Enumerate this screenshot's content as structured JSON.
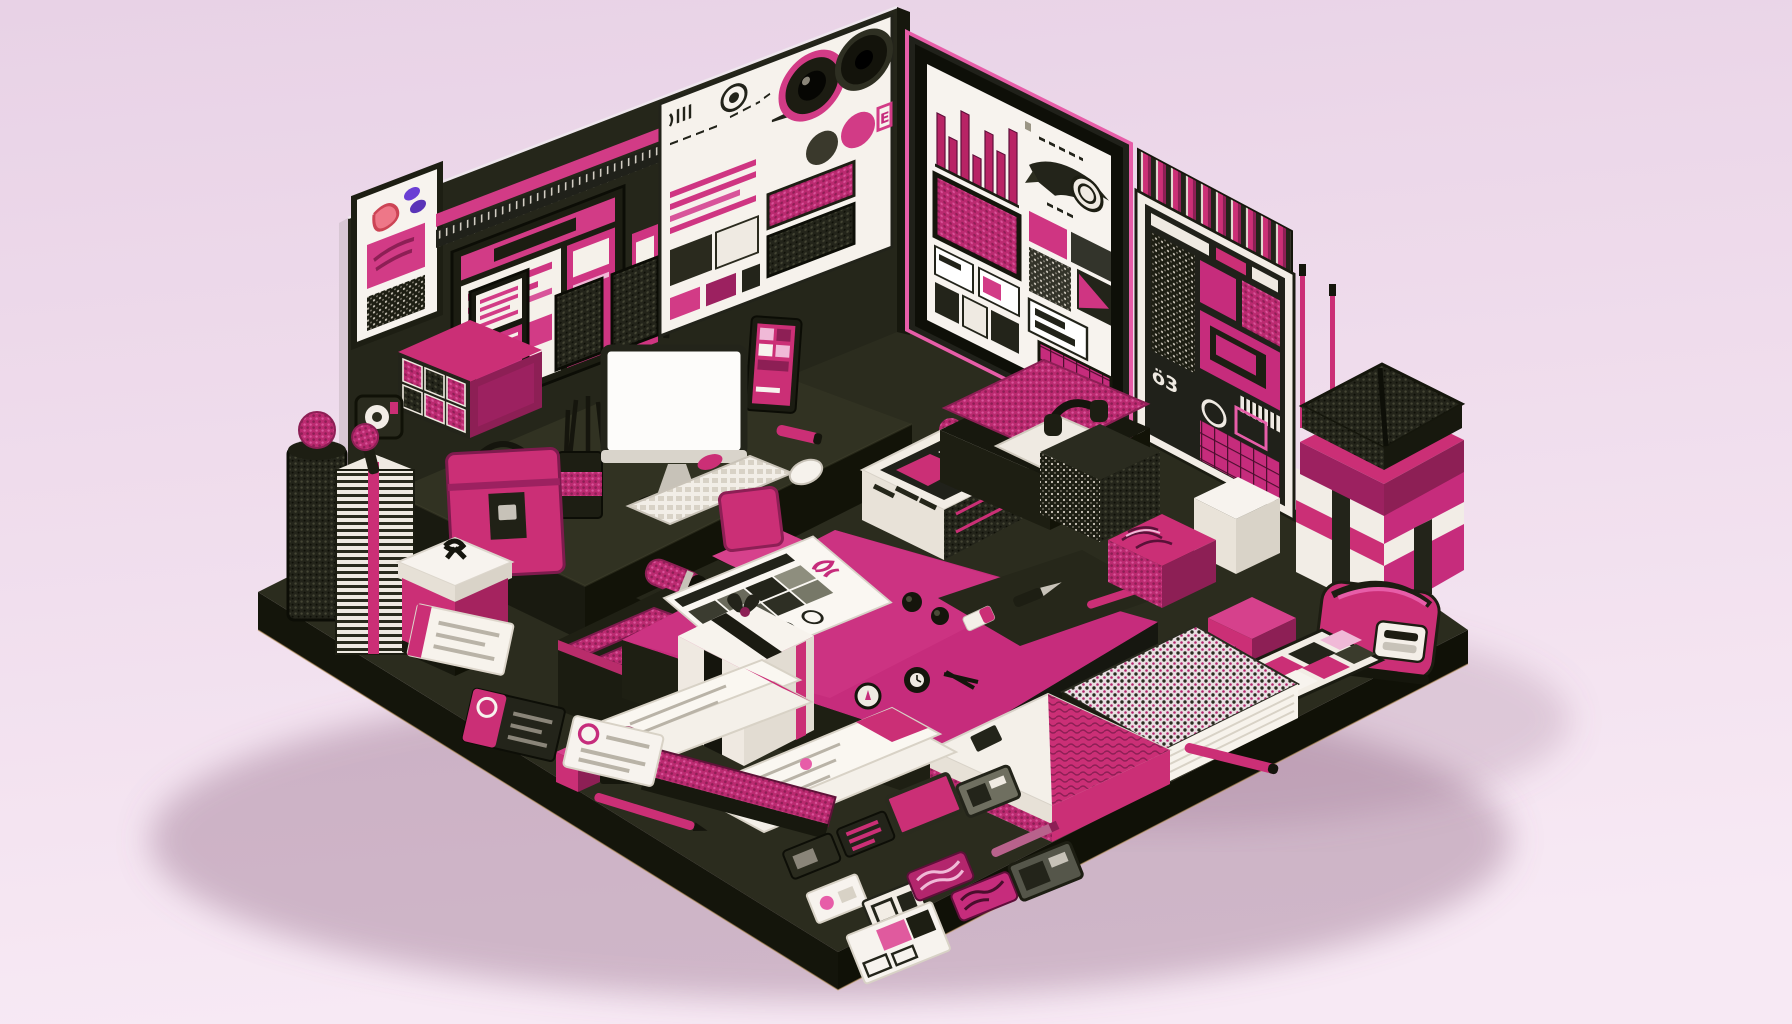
{
  "scene": {
    "title": "Isometric magenta design-studio diorama",
    "bg_top": "#e8d2e6",
    "bg_mid": "#efdcec",
    "bg_bottom": "#f7e9f4",
    "shadow_color": "rgba(141,100,128,0.38)"
  },
  "palette": {
    "magenta": "#c62c7c",
    "magenta_bright": "#d94a92",
    "magenta_deep": "#8d1f55",
    "pink_light": "#ec86bd",
    "pink_pale": "#f0b9d7",
    "dark": "#25261a",
    "dark_deep": "#15160c",
    "white": "#f7f3ee",
    "cream": "#e9e3d9",
    "silver": "#c7c2b8",
    "purple": "#6b3fd4"
  },
  "glyphs": {
    "g_card": "G",
    "rack_label": "ö3",
    "board_badge": "E"
  },
  "poster_chart": {
    "type": "bar",
    "values": [
      52,
      34,
      66,
      28,
      58,
      44,
      72
    ],
    "bar_color": "#b82465",
    "bar_edge": "#5f0f3a",
    "baseline_color": "#1d1e13"
  },
  "inventory": [
    "mood-board",
    "camera-lens-pink",
    "camera-lens-black",
    "color-dots",
    "swatch-cards",
    "ruler",
    "browser-wireframe-frame",
    "blob-poster",
    "qr-swatch",
    "g-card",
    "bar-chart-poster",
    "wing-logo",
    "halftone-blocks",
    "magazine-rack",
    "book-spines",
    "barcode",
    "antennas",
    "desk",
    "monitor",
    "keyboard",
    "mouse",
    "pen-cup",
    "office-chair",
    "tablet",
    "wall-knit-panels",
    "drawer-organizer",
    "briefcase",
    "waste-bin",
    "pompom",
    "paper-stack",
    "brush",
    "tape-dispenser",
    "white-lid-box",
    "lipstick",
    "futon-rolls",
    "pink-work-table",
    "swatch-sheet",
    "pocket-watch",
    "compass",
    "divider",
    "craft-knife",
    "pens",
    "eraser",
    "gift-box-black-ribbon",
    "canister",
    "dome-button",
    "design-box",
    "bed-lounge",
    "headphones",
    "pillow",
    "white-cube",
    "dotted-box",
    "marble-box",
    "parcel-stack",
    "zipper-bag",
    "pink-cubes",
    "palette-card",
    "dotted-notebook",
    "triangle-portfolio",
    "letter-sheets",
    "letter-strips",
    "business-cards",
    "stamp",
    "knit-brick",
    "card-chips",
    "usb-chips"
  ]
}
